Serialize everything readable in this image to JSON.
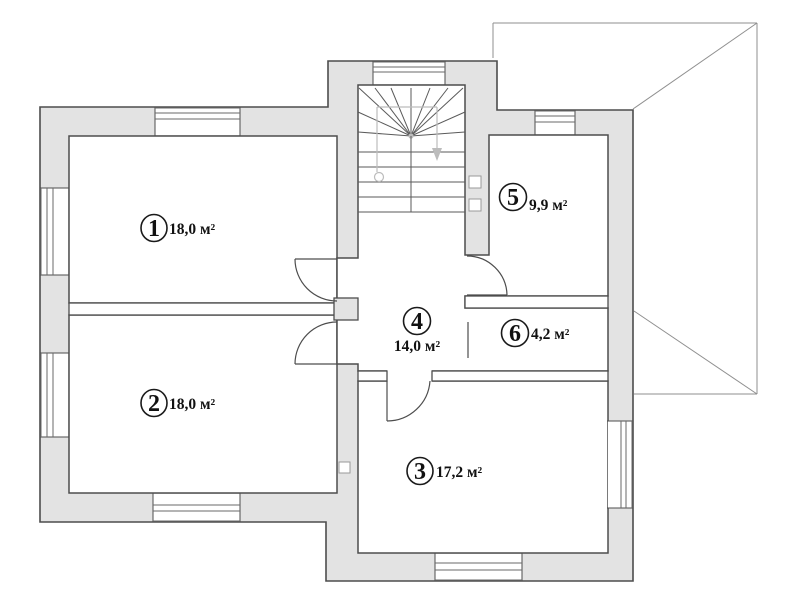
{
  "floor_plan": {
    "type": "residential-floor-plan",
    "unit": "м²",
    "rooms": [
      {
        "number": "1",
        "area_label": "18,0 м²"
      },
      {
        "number": "2",
        "area_label": "18,0 м²"
      },
      {
        "number": "3",
        "area_label": "17,2 м²"
      },
      {
        "number": "4",
        "area_label": "14,0 м²"
      },
      {
        "number": "5",
        "area_label": "9,9 м²"
      },
      {
        "number": "6",
        "area_label": "4,2 м²"
      }
    ],
    "features": {
      "staircase": "winder-stair-with-down-arrow",
      "adjacent_roof": "hip-roof-outline-right",
      "windows": 8,
      "vent_shafts": 3
    },
    "colors": {
      "wall_fill": "#e3e3e3",
      "outline": "#4d4d4d",
      "roof_line": "#8f8f8f",
      "stair_guide": "#bcbcbc",
      "background": "#ffffff"
    }
  }
}
